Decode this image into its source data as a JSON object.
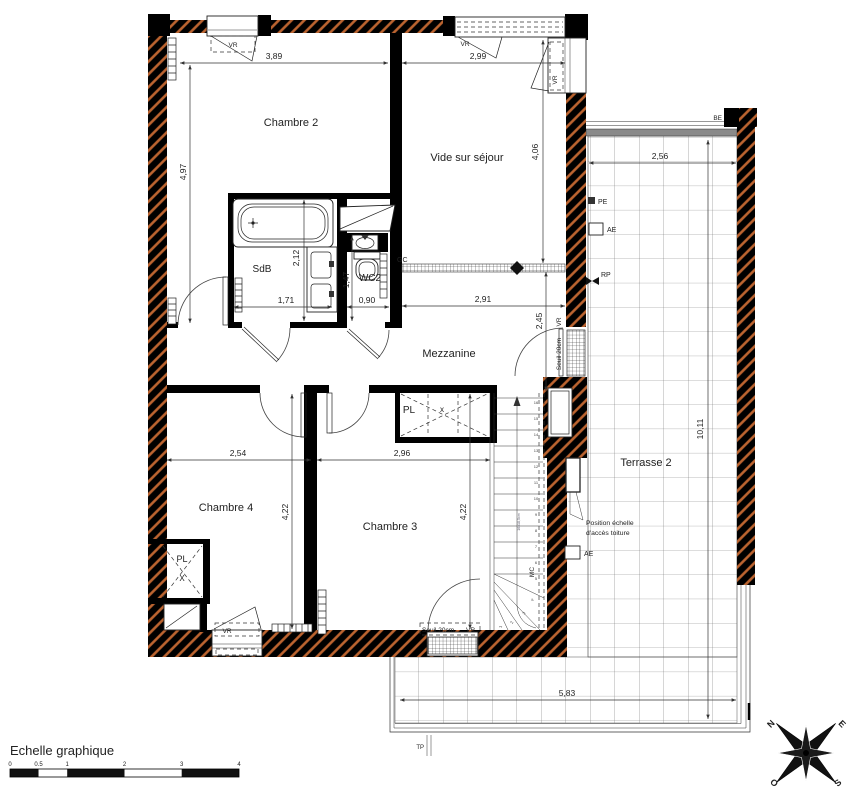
{
  "rooms": {
    "chambre2": "Chambre 2",
    "vide": "Vide sur séjour",
    "sdb": "SdB",
    "wc2": "WC2",
    "mezzanine": "Mezzanine",
    "chambre4": "Chambre 4",
    "chambre3": "Chambre 3",
    "terrasse2": "Terrasse 2"
  },
  "closets": {
    "pl": "PL",
    "x_big": "X",
    "x_small": "x"
  },
  "dims": {
    "d389": "3,89",
    "d299": "2,99",
    "d497": "4,97",
    "d406": "4,06",
    "d256": "2,56",
    "d212": "2,12",
    "d171": "1,71",
    "d147": "1,47",
    "d090": "0,90",
    "d291": "2,91",
    "d245": "2,45",
    "d254": "2,54",
    "d296": "2,96",
    "d422a": "4,22",
    "d422b": "4,22",
    "d1011": "10,11",
    "d583": "5,83"
  },
  "labels": {
    "vr": "VR",
    "gc": "GC",
    "be": "BE",
    "pe": "PE",
    "ae": "AE",
    "rp": "RP",
    "tp": "TP",
    "mc": "MC",
    "seuil20": "Seuil 20cm",
    "stair_note": "16x18,5cm",
    "ladder_line1": "Position échelle",
    "ladder_line2": "d'accès toiture"
  },
  "stairs": {
    "numbers": [
      "16",
      "15",
      "14",
      "13",
      "12",
      "11",
      "10",
      "9",
      "8",
      "7",
      "6",
      "5",
      "4",
      "3",
      "2",
      "1"
    ]
  },
  "scale_bar": {
    "title": "Echelle graphique",
    "ticks": [
      "0",
      "0.5",
      "1",
      "2",
      "3",
      "4"
    ]
  },
  "compass": {
    "n": "N",
    "e": "E",
    "s": "S",
    "o": "O"
  },
  "colors": {
    "wall": "#000000",
    "hatch": "#bc6430",
    "line": "#333333",
    "grid": "#777777",
    "band": "#8a8a8a"
  }
}
